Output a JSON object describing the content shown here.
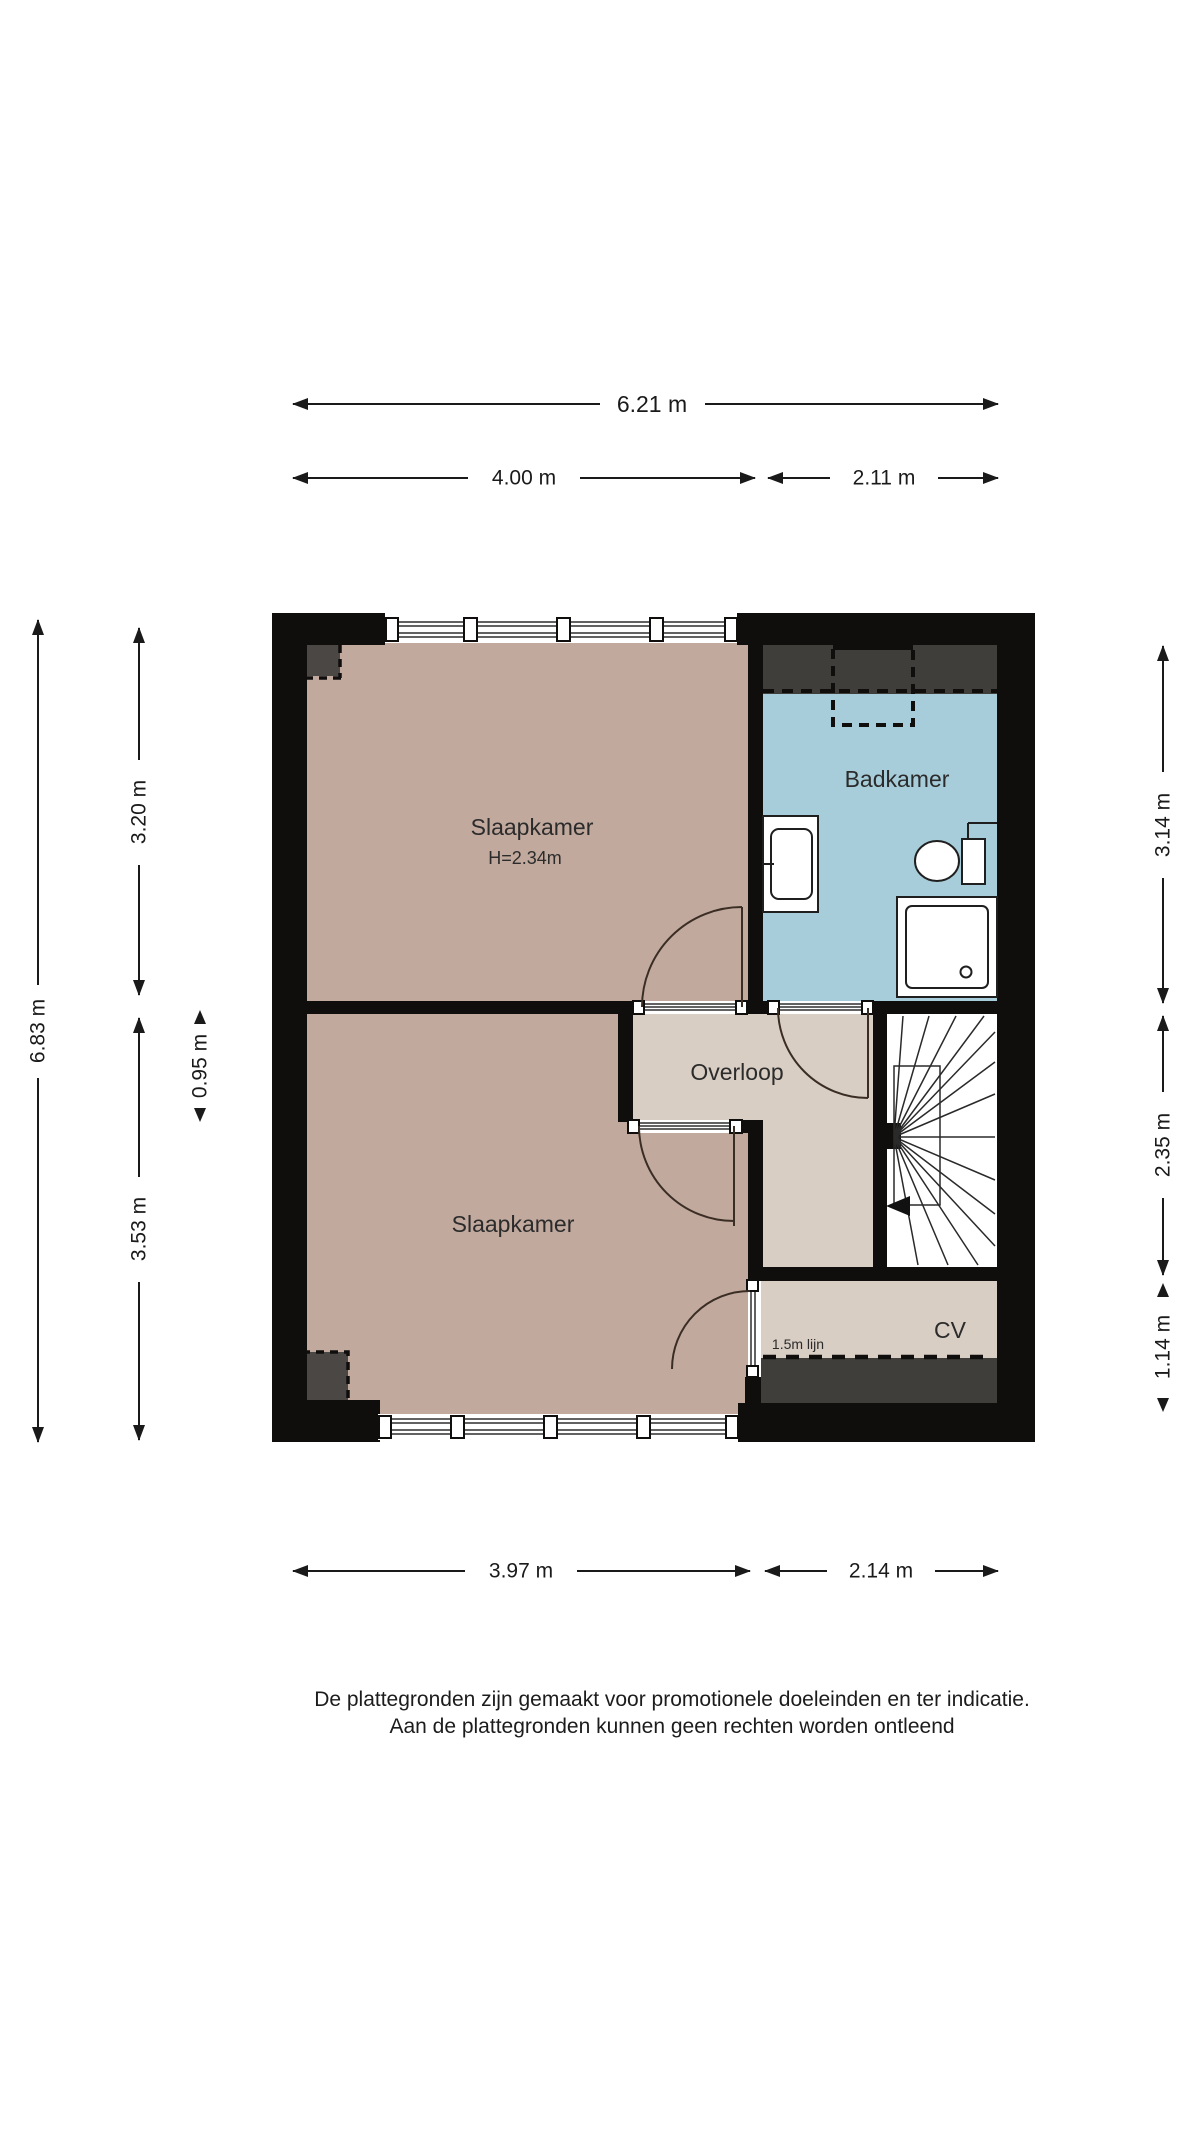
{
  "rooms": {
    "bedroom_top": {
      "label": "Slaapkamer",
      "ceiling_height": "H=2.34m"
    },
    "bedroom_bottom": {
      "label": "Slaapkamer"
    },
    "bathroom": {
      "label": "Badkamer"
    },
    "landing": {
      "label": "Overloop"
    },
    "boiler": {
      "label": "CV",
      "height_line_label": "1.5m lijn"
    }
  },
  "dimensions": {
    "top_total": "6.21 m",
    "top_left": "4.00 m",
    "top_right": "2.11 m",
    "bottom_left": "3.97 m",
    "bottom_right": "2.14 m",
    "left_total": "6.83 m",
    "left_top": "3.20 m",
    "left_middle": "0.95 m",
    "left_bottom": "3.53 m",
    "right_top": "3.14 m",
    "right_middle": "2.35 m",
    "right_bottom": "1.14 m"
  },
  "disclaimer": {
    "line1": "De plattegronden zijn gemaakt voor promotionele doeleinden en ter indicatie.",
    "line2": "Aan de plattegronden kunnen geen rechten worden ontleend"
  },
  "colors": {
    "wall": "#0f0e0c",
    "bedroom_floor": "#c2a99e",
    "landing_floor": "#d9cec4",
    "bathroom_floor": "#a7cdda",
    "stairs_floor": "#ffffff",
    "lowered_zone": "#4a4744",
    "lowered_strip": "#3f3e3a",
    "dim_line": "#1a1a1a",
    "label_text": "#2b2b2b"
  }
}
